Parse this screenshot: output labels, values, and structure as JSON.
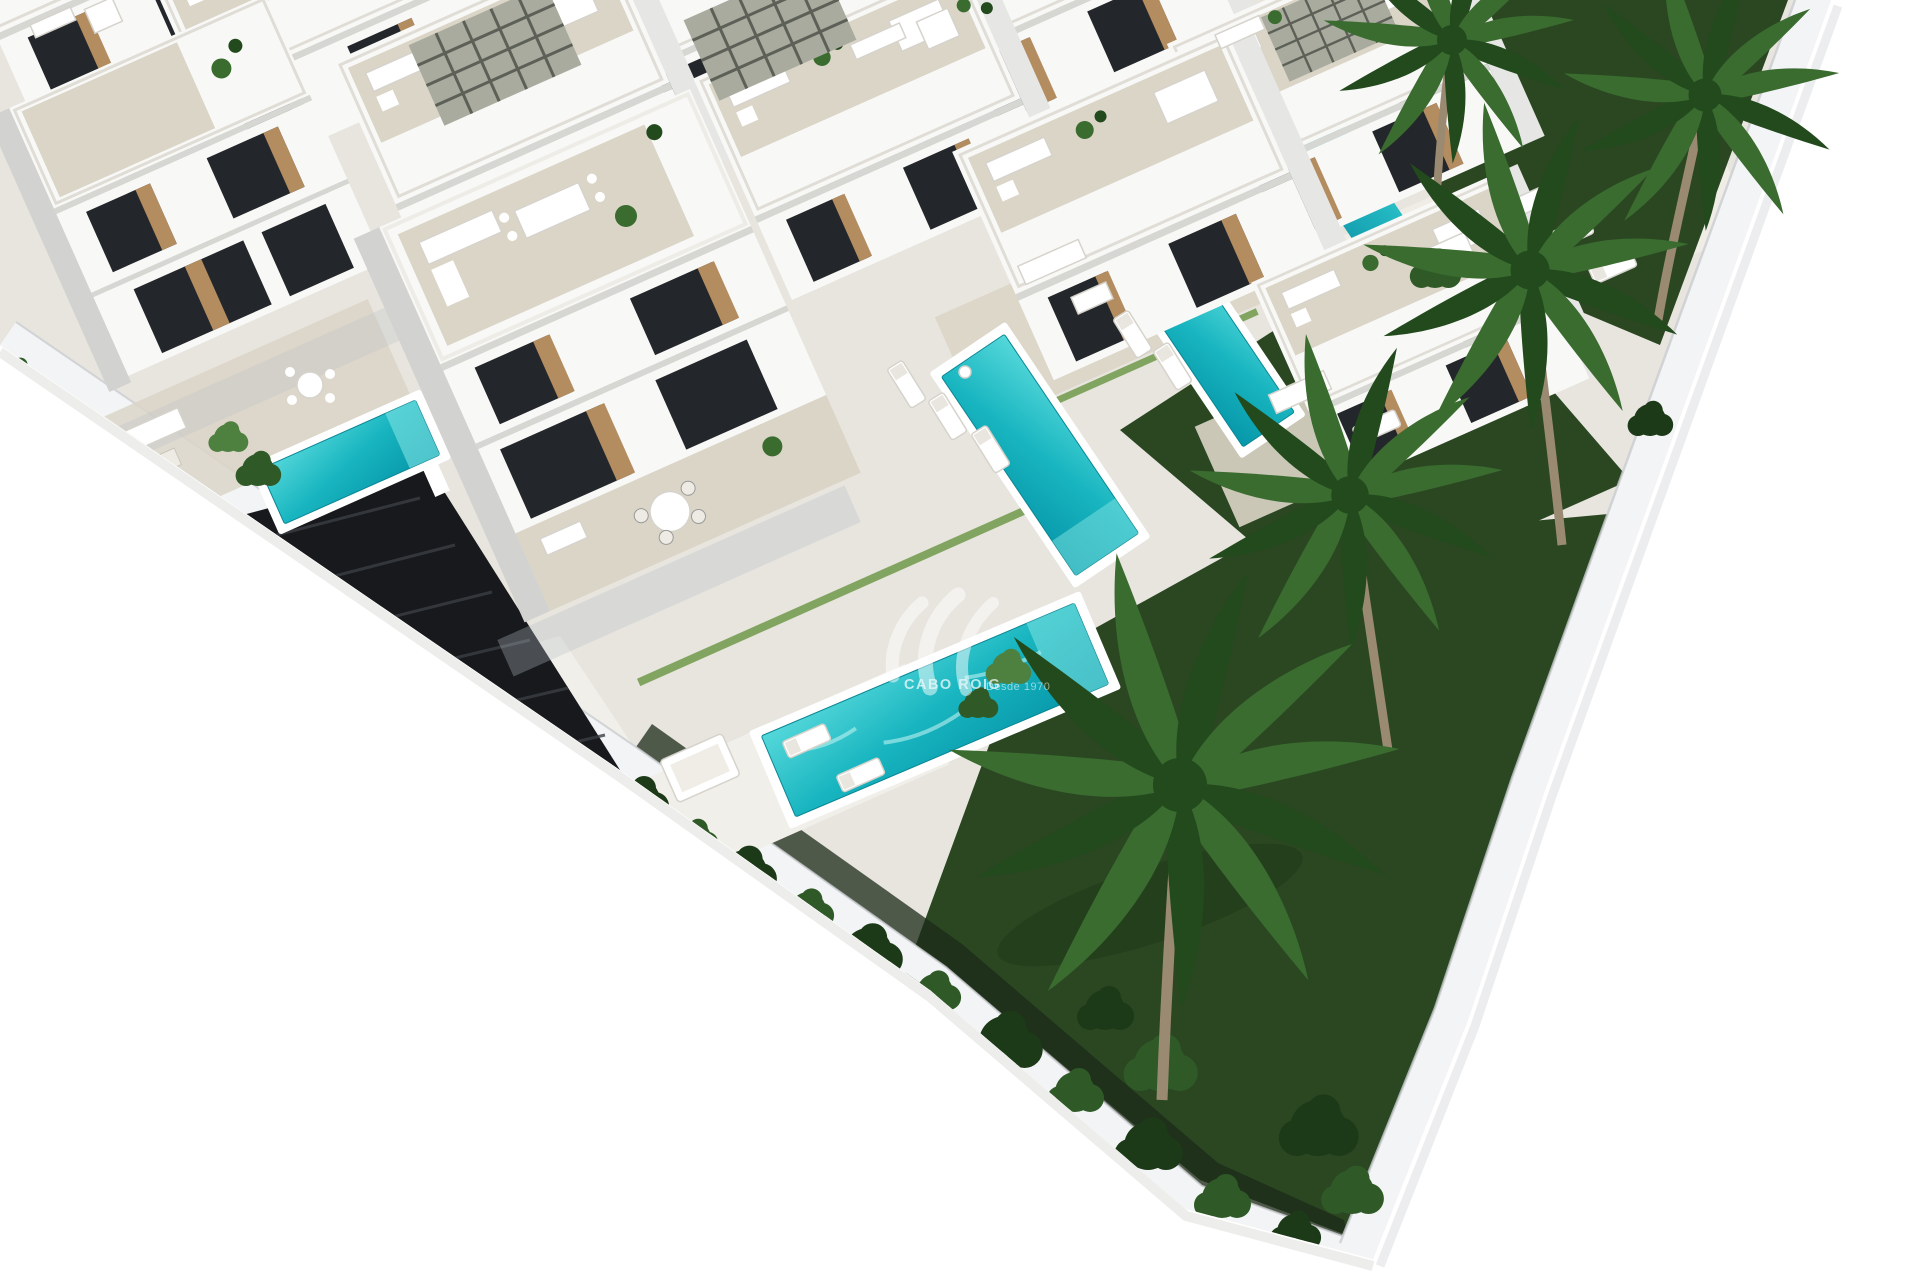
{
  "image": {
    "type": "architectural-3d-render",
    "description": "Aerial 3D rendering of a modern development of white two-storey villas with rooftop terraces, private turquoise pools, landscaped lawns, palm trees, black entrance gates, two parked SUVs and a white perimeter wall on a white background",
    "view": "oblique aerial / isometric, site rotated diagonally with white empty margins at bottom-left and right"
  },
  "watermark": {
    "brand": "CABO ROIG",
    "tagline": "Desde 1970",
    "logo": "swoosh-monogram"
  },
  "scene": {
    "villas_visible": 10,
    "pools_visible": 6,
    "palm_trees": 5,
    "vehicles": [
      {
        "type": "suv",
        "color": "silver"
      },
      {
        "type": "suv",
        "color": "black"
      }
    ],
    "features": [
      "rooftop terraces with outdoor furniture",
      "pergola roof decks",
      "private pools",
      "sun loungers",
      "outdoor dining sets",
      "black entrance gates and garage doors",
      "white perimeter wall",
      "dark green lawns",
      "tropical shrubs and palm trees"
    ]
  },
  "colors": {
    "bg": "#ffffff",
    "pavement": "#e8e5df",
    "pavement_light": "#f1efe9",
    "terrace": "#dbd5c8",
    "building": "#f8f8f6",
    "building_shade": "#e6e6e4",
    "building_dark": "#d2d2d0",
    "window": "#23262a",
    "wood": "#b38c60",
    "lawn": "#2a4722",
    "hedge": "#6f9a4a",
    "shrub": "#2f5a28",
    "shrub_dark": "#1d3a18",
    "shrub_light": "#4e8040",
    "palm": "#3a6b2f",
    "palm_dark": "#224a1d",
    "trunk": "#9b8a72",
    "wall": "#f3f4f6",
    "wall_shade": "#c9ccd0",
    "gate": "#17191c",
    "gate_line": "#3b3f44",
    "car_silver": "#c6c7c9",
    "car_dark": "#14161a",
    "pool_light": "#55d8da",
    "pool": "#18b5c0",
    "pool_deep": "#0797a9",
    "shadow": "#b9c0c6",
    "watermark": "#ffffff"
  }
}
